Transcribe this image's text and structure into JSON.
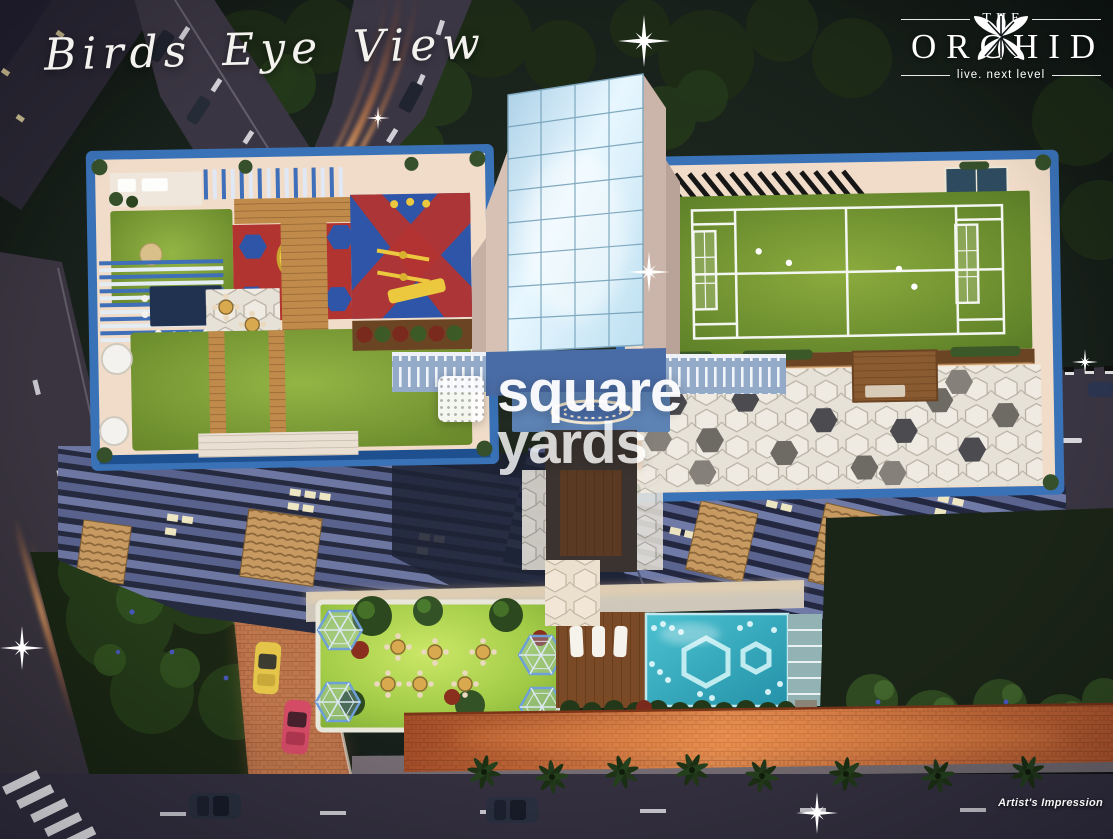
{
  "image": {
    "kind": "artist-impression-aerial-render",
    "alt": "Night-time bird's eye view 3D render of The Orchid residential tower: rooftop kids play area and lounge deck, rooftop sports court with hexagon-tile patio, central glass lift tower, landscaped podium garden with gazebos, swimming pool with hexagon mosaics, boundary wall with palm trees and surrounding roads with light trails"
  },
  "title_overlay": {
    "text": "Birds Eye View"
  },
  "brand": {
    "pre": "THE",
    "name": "ORCHID",
    "tagline": "live. next level",
    "logo_icon": "orchid-flower-icon"
  },
  "watermark": {
    "word1": "square",
    "word2": "yards",
    "logo_icon": "square-yards-logo-icon"
  },
  "footnote": {
    "text": "Artist's Impression"
  },
  "icons": [
    "orchid-flower-icon",
    "square-yards-logo-icon",
    "sparkle-flare-icon",
    "palm-tree-icon"
  ],
  "colors": {
    "night_background": "#131a12",
    "podium_border_blue": "#3a72b8",
    "podium_cream": "#f0dcc8",
    "glass_blue": "#cfe9f8",
    "court_turf_green": "#6d8f2f",
    "lawn_green": "#9fca45",
    "pool_teal": "#3fb4c4",
    "pool_mosaic": "#c8f0f4",
    "play_mat_red": "#b23430",
    "play_mat_blue": "#2f55a8",
    "play_equipment_yellow": "#e9c53d",
    "wood_deck_brown": "#8a5a30",
    "boundary_wall_orange": "#d97b3f",
    "brick_paver": "#b06a48",
    "road_asphalt": "#39343f",
    "light_trail_orange": "#ff8c3a",
    "text_white": "#ffffff"
  }
}
